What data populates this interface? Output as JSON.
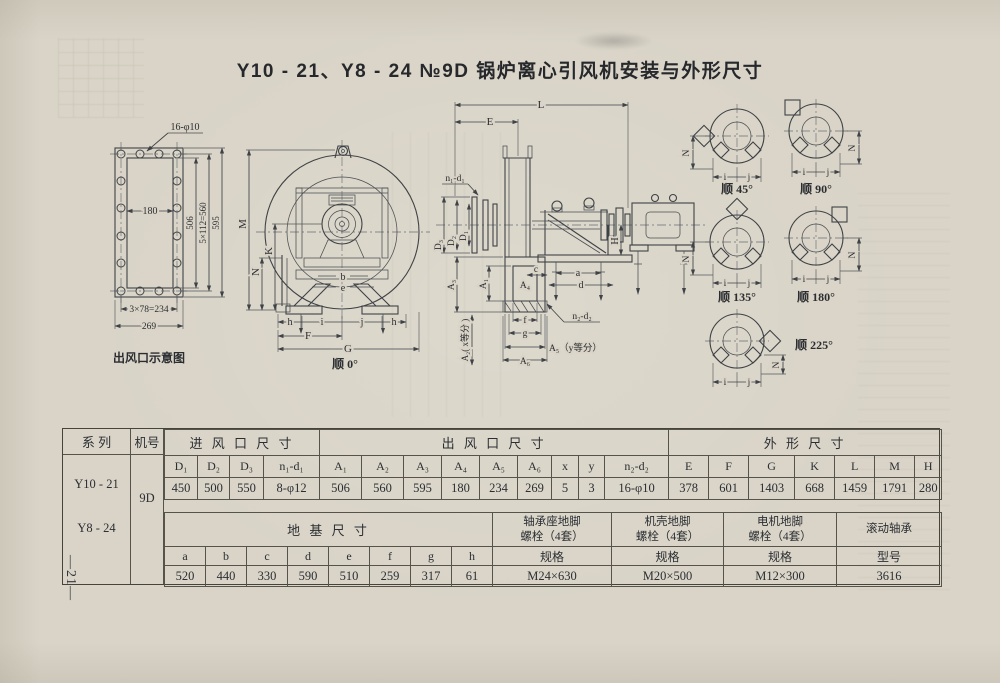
{
  "page": {
    "title": "Y10 - 21、Y8 - 24 №9D 锅炉离心引风机安装与外形尺寸",
    "page_number": "—21—"
  },
  "drawings": {
    "flange": {
      "caption": "出风口示意图",
      "holes_note": "16-φ10",
      "inner_width": "180",
      "dim_506": "506",
      "dim_560": "5×112=560",
      "dim_595": "595",
      "dim_234": "3×78=234",
      "dim_269": "269"
    },
    "front": {
      "caption": "顺 0°",
      "dim_M": "M",
      "dim_N": "N",
      "dim_K": "K",
      "dim_b": "b",
      "dim_e": "e",
      "dim_h": "h",
      "dim_i": "i",
      "dim_j": "j",
      "dim_F": "F",
      "dim_G": "G"
    },
    "side": {
      "dim_L": "L",
      "dim_E": "E",
      "n1_d1": "n₁-d₁",
      "dim_D1": "D₁",
      "dim_D2": "D₂",
      "dim_D3": "D₃",
      "dim_A1": "A₁",
      "dim_A2": "A₂( x等分 )",
      "dim_A3": "A₃",
      "dim_A4": "A₄",
      "dim_A5": "A₅（y等分）",
      "dim_A6": "A₆",
      "dim_a": "a",
      "dim_c": "c",
      "dim_d": "d",
      "dim_f": "f",
      "dim_g": "g",
      "dim_H": "H",
      "n2_d2": "n₂-d₂"
    },
    "orientations": {
      "captions": [
        "顺 45°",
        "顺 90°",
        "顺 135°",
        "顺 180°",
        "顺 225°"
      ],
      "dim_N": "N",
      "dim_i": "i",
      "dim_j": "j"
    }
  },
  "table": {
    "series_header": "系 列",
    "machine_header": "机号",
    "series_1": "Y10 - 21",
    "series_2": "Y8 - 24",
    "machine_no": "9D",
    "group_inlet": "进 风 口 尺 寸",
    "group_outlet": "出 风 口 尺 寸",
    "group_outline": "外 形 尺 寸",
    "group_foundation": "地 基 尺 寸",
    "inlet": {
      "headers": [
        "D₁",
        "D₂",
        "D₃",
        "n₁-d₁"
      ],
      "values": [
        "450",
        "500",
        "550",
        "8-φ12"
      ]
    },
    "outlet": {
      "headers": [
        "A₁",
        "A₂",
        "A₃",
        "A₄",
        "A₅",
        "A₆",
        "x",
        "y",
        "n₂-d₂"
      ],
      "values": [
        "506",
        "560",
        "595",
        "180",
        "234",
        "269",
        "5",
        "3",
        "16-φ10"
      ]
    },
    "outline": {
      "headers": [
        "E",
        "F",
        "G",
        "K",
        "L",
        "M",
        "H"
      ],
      "values": [
        "378",
        "601",
        "1403",
        "668",
        "1459",
        "1791",
        "280"
      ]
    },
    "foundation": {
      "headers": [
        "a",
        "b",
        "c",
        "d",
        "e",
        "f",
        "g",
        "h"
      ],
      "values": [
        "520",
        "440",
        "330",
        "590",
        "510",
        "259",
        "317",
        "61"
      ]
    },
    "bolts": [
      {
        "header": "轴承座地脚\n螺栓（4套）",
        "sub": "规格",
        "value": "M24×630"
      },
      {
        "header": "机壳地脚\n螺栓（4套）",
        "sub": "规格",
        "value": "M20×500"
      },
      {
        "header": "电机地脚\n螺栓（4套）",
        "sub": "规格",
        "value": "M12×300"
      },
      {
        "header": "滚动轴承",
        "sub": "型号",
        "value": "3616"
      }
    ]
  }
}
